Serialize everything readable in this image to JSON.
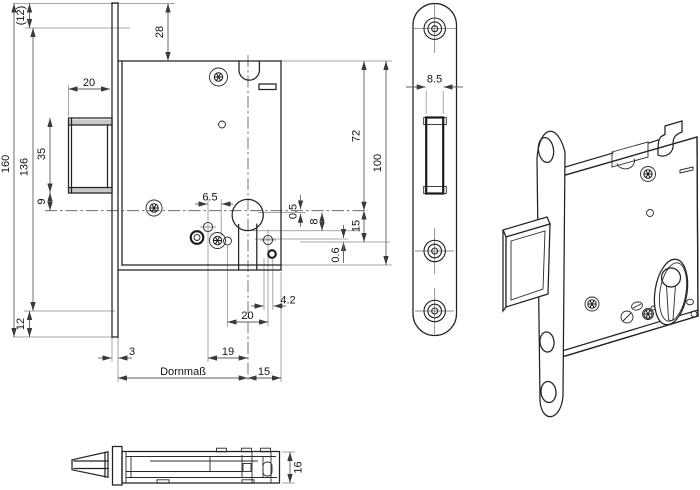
{
  "colors": {
    "background": "#ffffff",
    "part_edge": "#222222",
    "dimension_line": "#5f5f5f",
    "extension_line": "#8a8a8a",
    "label_text": "#141414"
  },
  "dims": {
    "total_height": "160",
    "hole_span": "136",
    "top_hole_offset": "(12)",
    "bottom_hole_offset": "12",
    "bolt_face_height": "35",
    "bolt_to_center": "9",
    "bolt_width": "20",
    "case_top_offset": "28",
    "pin_offset": "6.5",
    "latch_step": "0.5",
    "follower_offset": "8",
    "lower_offset": "15",
    "case_height_upper": "72",
    "case_height": "100",
    "play": "0.6",
    "slot_offset": "4.2",
    "pin_span": "20",
    "pin_backset": "19",
    "plate_thickness": "3",
    "backset_label": "Dornmaß",
    "case_front": "15",
    "latch_slot_width": "8.5",
    "case_depth": "16"
  }
}
